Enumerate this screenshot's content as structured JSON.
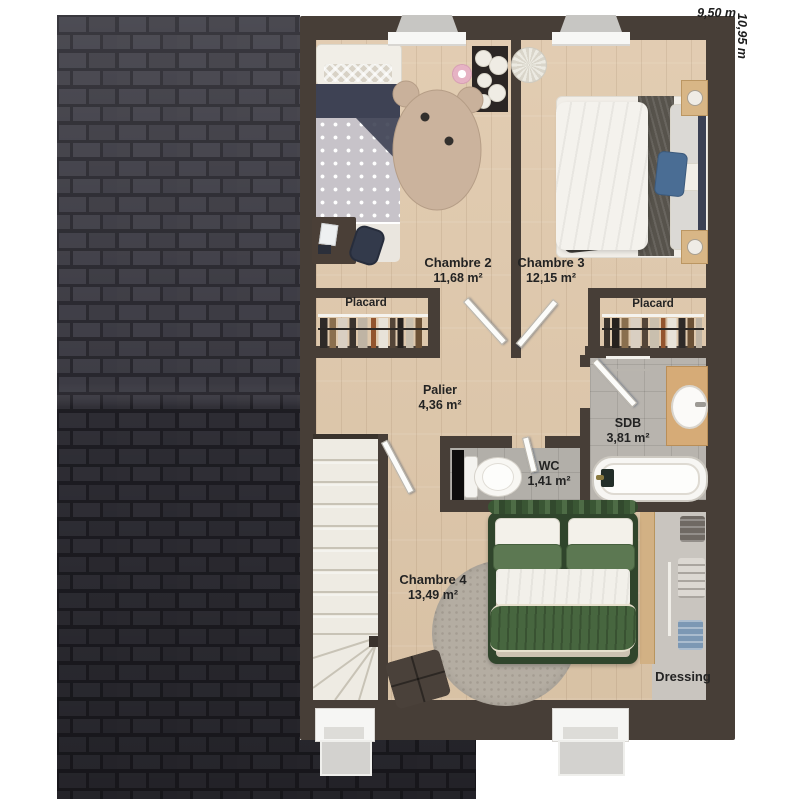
{
  "plan": {
    "dimensions": {
      "width_label": "9,50 m",
      "height_label": "10,95 m"
    },
    "rooms": {
      "chambre2": {
        "name": "Chambre 2",
        "area": "11,68 m²"
      },
      "chambre3": {
        "name": "Chambre 3",
        "area": "12,15 m²"
      },
      "placard_left": {
        "name": "Placard"
      },
      "placard_right": {
        "name": "Placard"
      },
      "palier": {
        "name": "Palier",
        "area": "4,36 m²"
      },
      "sdb": {
        "name": "SDB",
        "area": "3,81 m²"
      },
      "wc": {
        "name": "WC",
        "area": "1,41 m²"
      },
      "chambre4": {
        "name": "Chambre 4",
        "area": "13,49 m²"
      },
      "dressing": {
        "name": "Dressing"
      }
    },
    "colors": {
      "roof": "#34333a",
      "exterior_wall": "#473e37",
      "wood_floor": "#ddc8ad",
      "tile_floor": "#b8b4ae",
      "bed_green": "#30452c",
      "accent_blue": "#4a6d94"
    }
  }
}
